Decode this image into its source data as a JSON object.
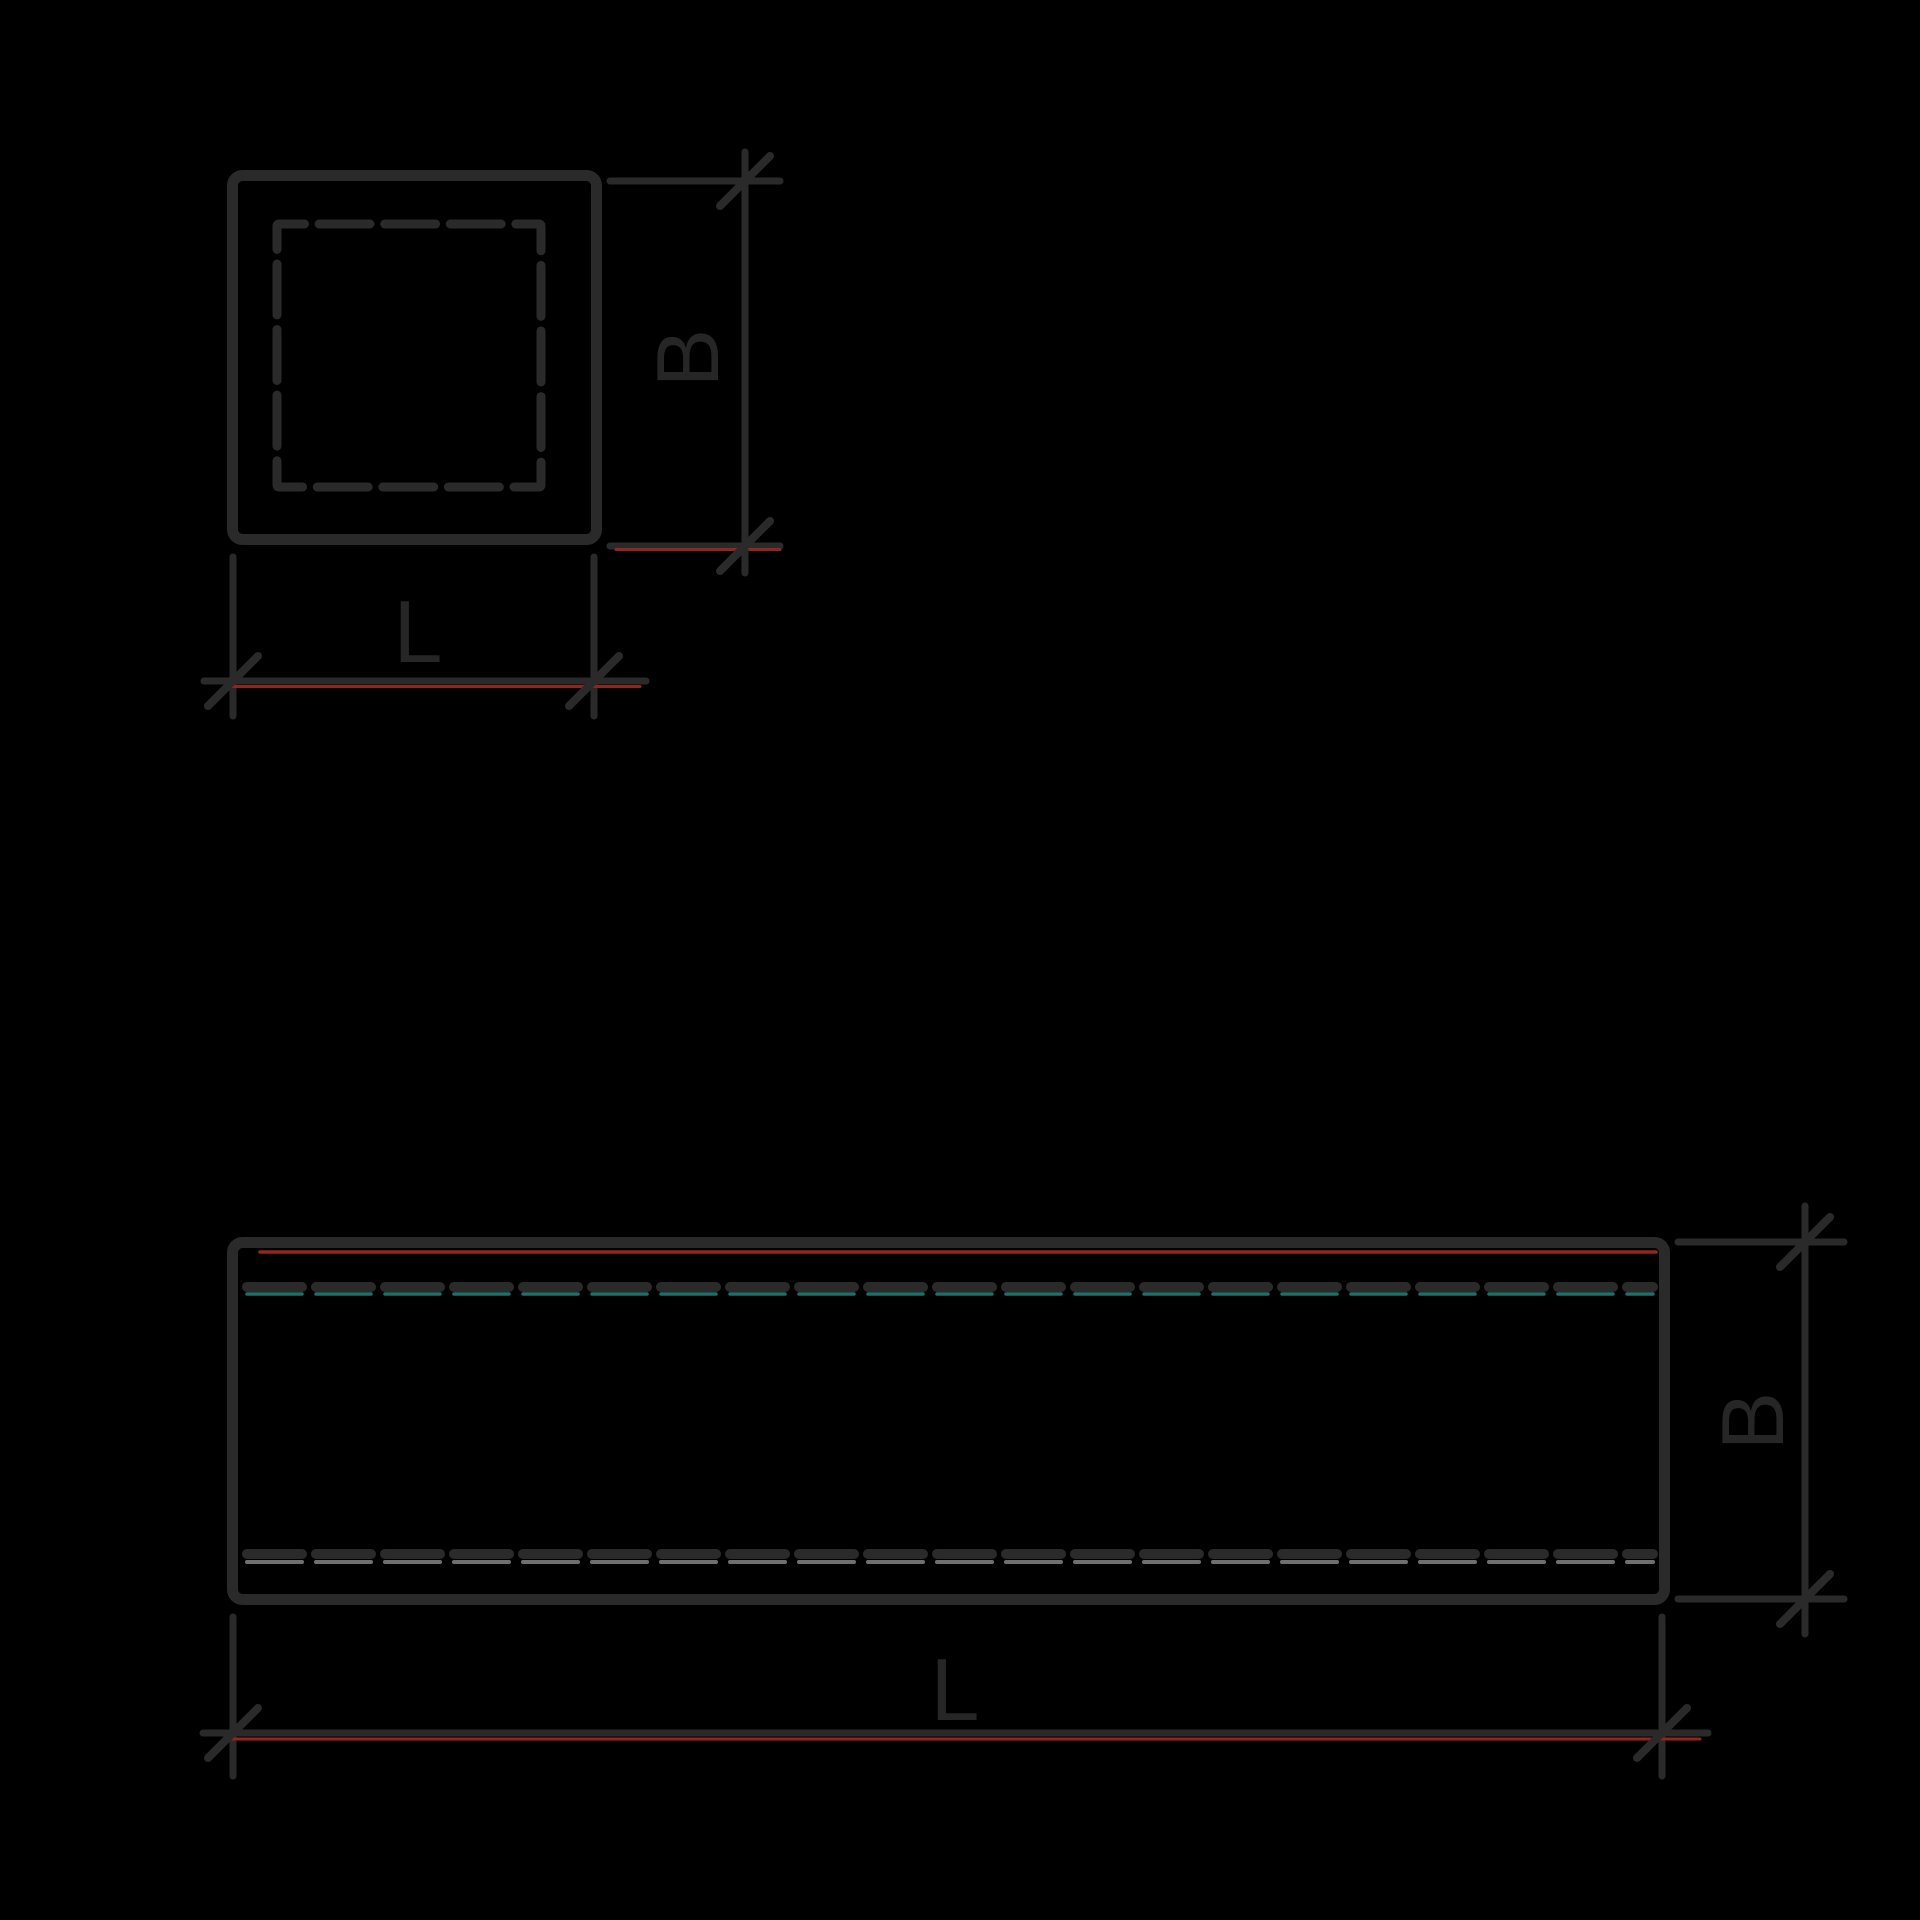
{
  "drawing": {
    "cross_section": {
      "height_label": "B",
      "length_label": "L"
    },
    "side_view": {
      "height_label": "B",
      "length_label": "L"
    }
  },
  "colors": {
    "background": "#000000",
    "stroke_main": "#2a2a2a",
    "text_color": "#262626",
    "red_accent": "#8f2622",
    "teal_accent": "#1e6f67",
    "gray_accent": "#6f6f6f"
  }
}
